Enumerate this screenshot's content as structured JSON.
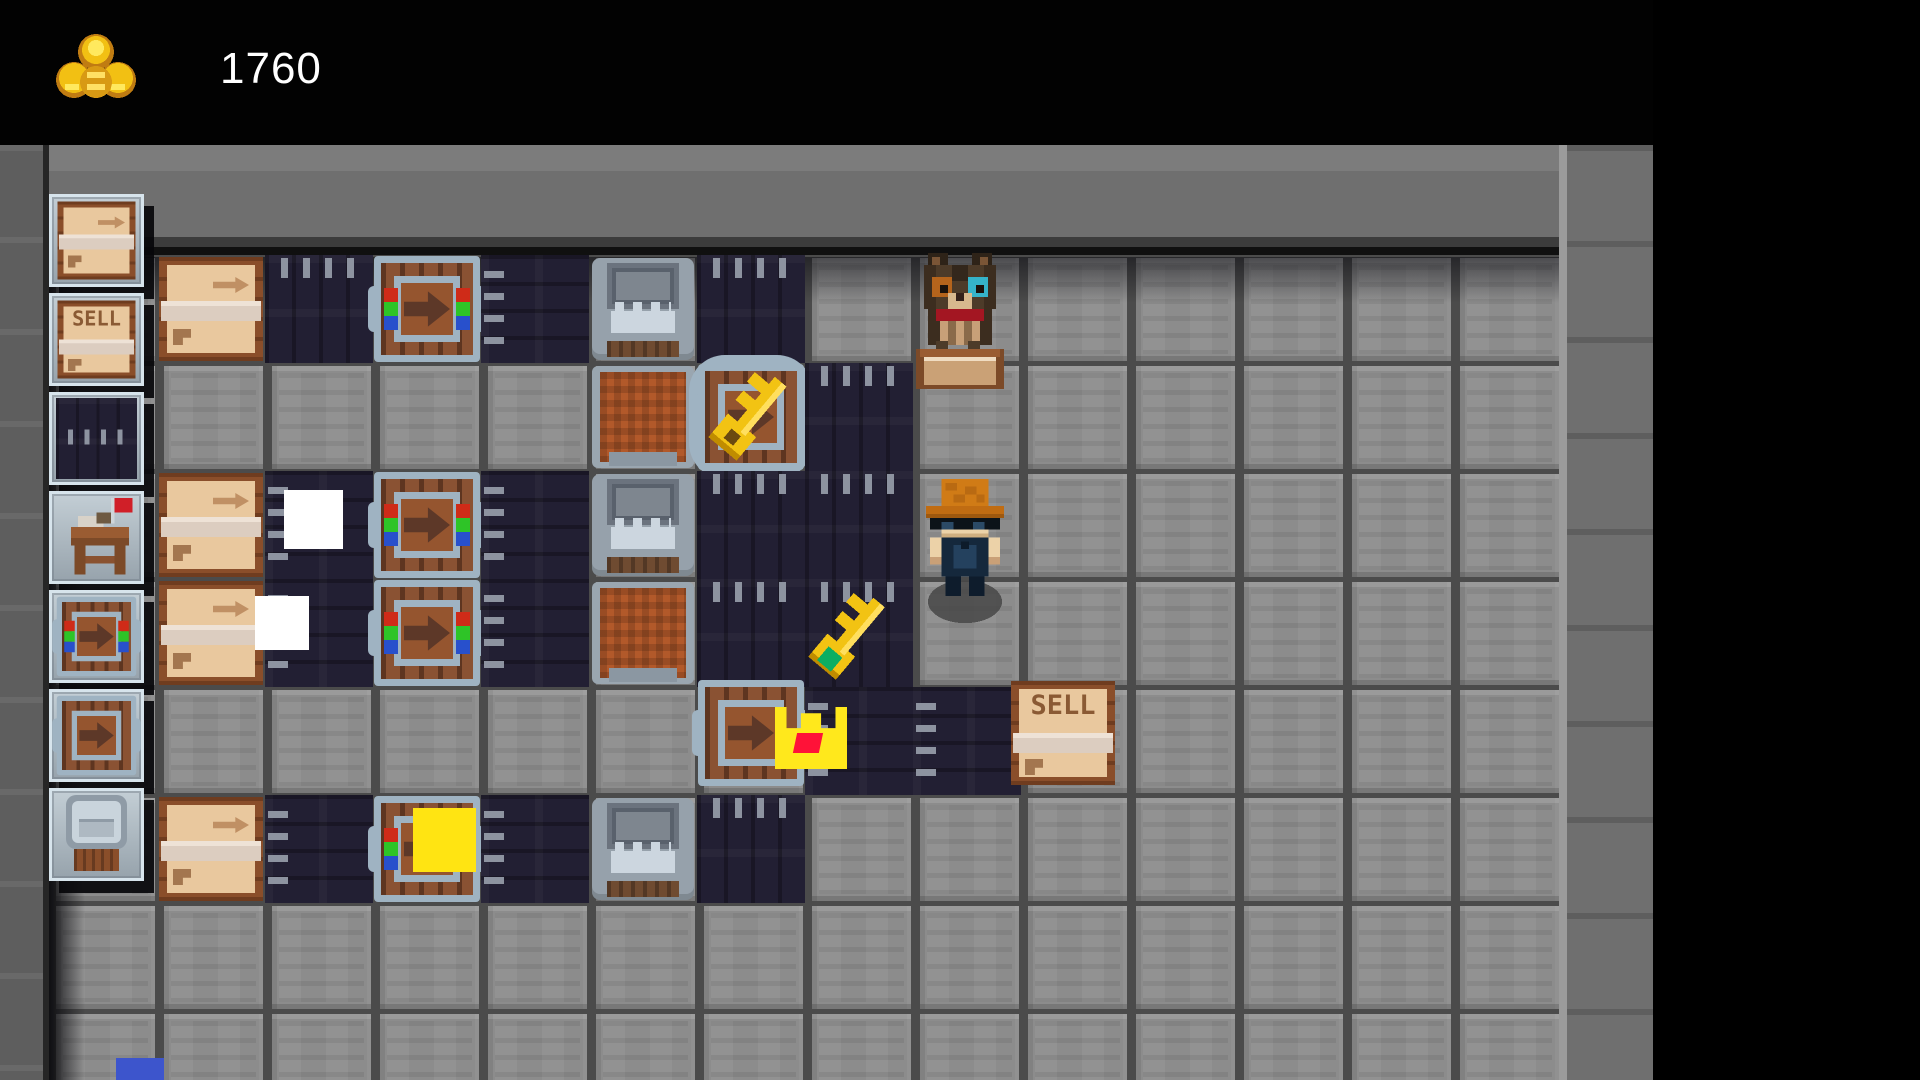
{
  "hud": {
    "coins": "1760",
    "icon": "gold-pile-icon"
  },
  "labels": {
    "sell": "SELL"
  },
  "colors": {
    "hud_gold": "#f2c013",
    "belt": "#221f33",
    "machine_frame": "#9fb3c2",
    "crate_fill": "#e9c89e",
    "crate_frame": "#8a4e2a",
    "dot_red": "#cf2b18",
    "dot_green": "#2ec427",
    "dot_blue": "#2850cc",
    "item_gold": "#f2c313",
    "crown_yellow": "#ffe81c",
    "gem_red": "#ff1238",
    "gem_green": "#0cae62"
  },
  "sidebar": {
    "slots": [
      {
        "name": "crate-dispenser",
        "sprite": "crate"
      },
      {
        "name": "sell-crate",
        "sprite": "sell"
      },
      {
        "name": "conveyor-belt",
        "sprite": "belt"
      },
      {
        "name": "market-stall",
        "sprite": "stall"
      },
      {
        "name": "sorter-machine",
        "sprite": "sorter"
      },
      {
        "name": "pusher-machine",
        "sprite": "machine"
      },
      {
        "name": "press-machine",
        "sprite": "grabber"
      }
    ]
  },
  "board": {
    "origin_x": 157,
    "origin_y": 255,
    "tile": 108,
    "cols": 13,
    "rows": 8,
    "sprites": [
      {
        "t": "crate",
        "c": 0,
        "r": 0
      },
      {
        "t": "belt_v",
        "c": 1,
        "r": 0
      },
      {
        "t": "sorter",
        "c": 2,
        "r": 0
      },
      {
        "t": "belt_h",
        "c": 3,
        "r": 0
      },
      {
        "t": "press",
        "c": 4,
        "r": 0
      },
      {
        "t": "belt_v",
        "c": 5,
        "r": 0
      },
      {
        "t": "hopper",
        "c": 4,
        "r": 1
      },
      {
        "t": "key_machine",
        "c": 5,
        "r": 1
      },
      {
        "t": "belt_v",
        "c": 6,
        "r": 1
      },
      {
        "t": "crate",
        "c": 0,
        "r": 2
      },
      {
        "t": "belt_h",
        "c": 1,
        "r": 2
      },
      {
        "t": "sorter",
        "c": 2,
        "r": 2
      },
      {
        "t": "belt_h",
        "c": 3,
        "r": 2
      },
      {
        "t": "press",
        "c": 4,
        "r": 2
      },
      {
        "t": "belt_v",
        "c": 5,
        "r": 2
      },
      {
        "t": "belt_v",
        "c": 6,
        "r": 2
      },
      {
        "t": "crate",
        "c": 0,
        "r": 3
      },
      {
        "t": "belt_h",
        "c": 1,
        "r": 3
      },
      {
        "t": "sorter",
        "c": 2,
        "r": 3
      },
      {
        "t": "belt_h",
        "c": 3,
        "r": 3
      },
      {
        "t": "hopper",
        "c": 4,
        "r": 3
      },
      {
        "t": "belt_v",
        "c": 5,
        "r": 3
      },
      {
        "t": "belt_v",
        "c": 6,
        "r": 3
      },
      {
        "t": "machine",
        "c": 5,
        "r": 4,
        "dy": -8
      },
      {
        "t": "belt_h",
        "c": 6,
        "r": 4
      },
      {
        "t": "belt_h",
        "c": 7,
        "r": 4
      },
      {
        "t": "sell",
        "c": 8,
        "r": 4,
        "dx": -12,
        "dy": -8
      },
      {
        "t": "crate",
        "c": 0,
        "r": 5
      },
      {
        "t": "belt_h",
        "c": 1,
        "r": 5
      },
      {
        "t": "sorter",
        "c": 2,
        "r": 5
      },
      {
        "t": "belt_h",
        "c": 3,
        "r": 5
      },
      {
        "t": "press",
        "c": 4,
        "r": 5
      },
      {
        "t": "belt_v",
        "c": 5,
        "r": 5
      }
    ]
  },
  "items": [
    {
      "type": "white-square",
      "x": 284,
      "y": 490,
      "w": 59,
      "h": 59
    },
    {
      "type": "white-square",
      "x": 255,
      "y": 596,
      "w": 54,
      "h": 54
    },
    {
      "type": "gold-key",
      "x": 812,
      "y": 588,
      "w": 74,
      "h": 96
    },
    {
      "type": "gold-crown",
      "x": 775,
      "y": 707,
      "w": 72,
      "h": 62
    },
    {
      "type": "yellow-square",
      "x": 413,
      "y": 808,
      "w": 63,
      "h": 64
    },
    {
      "type": "blue-square",
      "x": 116,
      "y": 1058,
      "w": 48,
      "h": 22
    }
  ],
  "characters": [
    {
      "type": "cat",
      "x": 916,
      "y": 252,
      "w": 88,
      "h": 138
    },
    {
      "type": "player",
      "x": 926,
      "y": 478,
      "w": 78,
      "h": 146
    }
  ]
}
